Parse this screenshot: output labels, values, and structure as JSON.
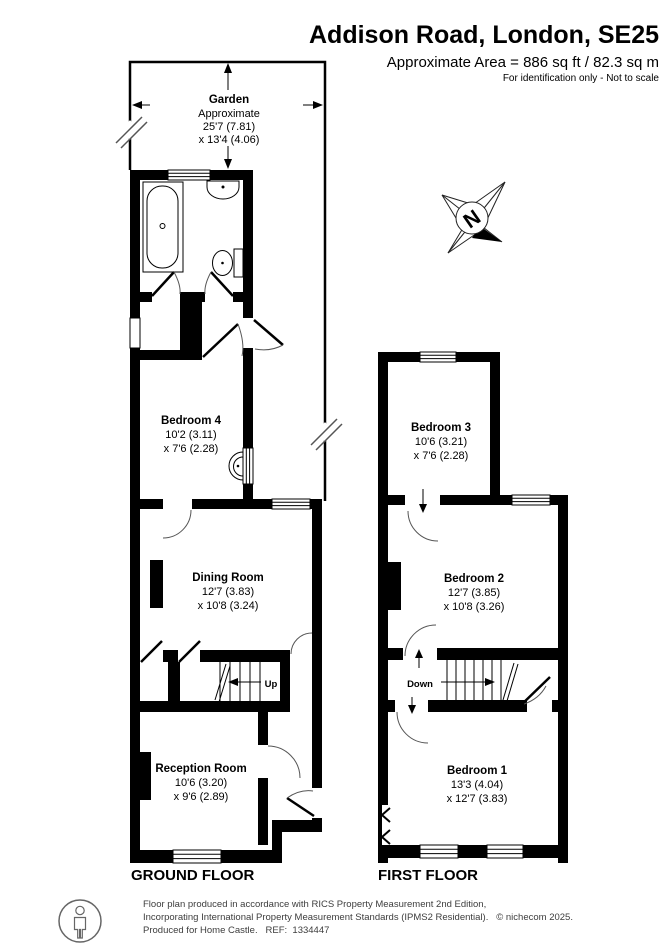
{
  "header": {
    "title": "Addison Road, London, SE25",
    "area_line": "Approximate Area = 886 sq ft / 82.3 sq m",
    "note_line": "For identification only - Not to scale"
  },
  "garden": {
    "name": "Garden",
    "approx": "Approximate",
    "dim1": "25'7 (7.81)",
    "dim2": "x 13'4 (4.06)"
  },
  "ground_floor": {
    "label": "GROUND FLOOR",
    "stairs_label": "Up",
    "rooms": {
      "bedroom4": {
        "name": "Bedroom 4",
        "dim1": "10'2 (3.11)",
        "dim2": "x 7'6 (2.28)"
      },
      "dining": {
        "name": "Dining Room",
        "dim1": "12'7 (3.83)",
        "dim2": "x 10'8 (3.24)"
      },
      "reception": {
        "name": "Reception Room",
        "dim1": "10'6 (3.20)",
        "dim2": "x 9'6 (2.89)"
      }
    }
  },
  "first_floor": {
    "label": "FIRST FLOOR",
    "stairs_label": "Down",
    "rooms": {
      "bedroom3": {
        "name": "Bedroom 3",
        "dim1": "10'6 (3.21)",
        "dim2": "x 7'6 (2.28)"
      },
      "bedroom2": {
        "name": "Bedroom 2",
        "dim1": "12'7 (3.85)",
        "dim2": "x 10'8 (3.26)"
      },
      "bedroom1": {
        "name": "Bedroom 1",
        "dim1": "13'3 (4.04)",
        "dim2": "x 12'7 (3.83)"
      }
    }
  },
  "compass": {
    "north": "N"
  },
  "footer": {
    "line1": "Floor plan produced in accordance with RICS Property Measurement 2nd Edition,",
    "line2": "Incorporating International Property Measurement Standards (IPMS2 Residential).   © nichecom 2025.",
    "line3": "Produced for Home Castle.   REF:  1334447"
  },
  "colors": {
    "wall": "#000000",
    "background": "#ffffff",
    "footer_text": "#3d3d3d"
  }
}
